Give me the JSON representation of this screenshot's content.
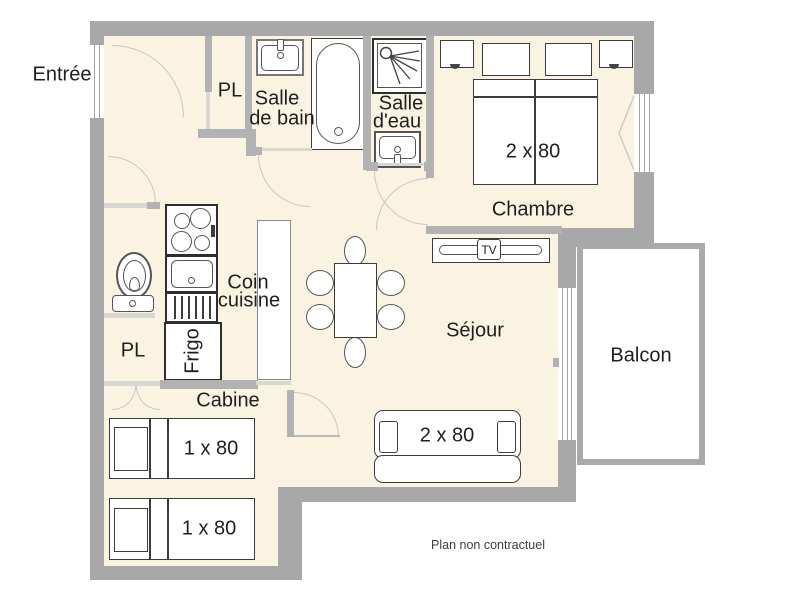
{
  "plan": {
    "note": "Plan non contractuel",
    "rooms": {
      "entree": "Entrée",
      "pl_top": "PL",
      "salle_de_bain": [
        "Salle",
        "de bain"
      ],
      "salle_deau": [
        "Salle",
        "d'eau"
      ],
      "chambre": "Chambre",
      "coin_cuisine": [
        "Coin",
        "cuisine"
      ],
      "pl_bottom": "PL",
      "sejour": "Séjour",
      "cabine": "Cabine",
      "balcon": "Balcon"
    },
    "furniture": {
      "double_bed": "2 x 80",
      "sofa_bed": "2 x 80",
      "single_bed_top": "1 x 80",
      "single_bed_bottom": "1 x 80",
      "fridge": "Frigo",
      "tv": "TV"
    },
    "colors": {
      "floor": "#faf3e2",
      "wall": "#a8a8a8",
      "wall2": "#b2b2b2",
      "wall3": "#d8d8d2",
      "outline": "#3c3c3c",
      "arc": "#c6c6c2",
      "label": "#1f1f1f",
      "balcony": "#a9a9a9"
    }
  }
}
